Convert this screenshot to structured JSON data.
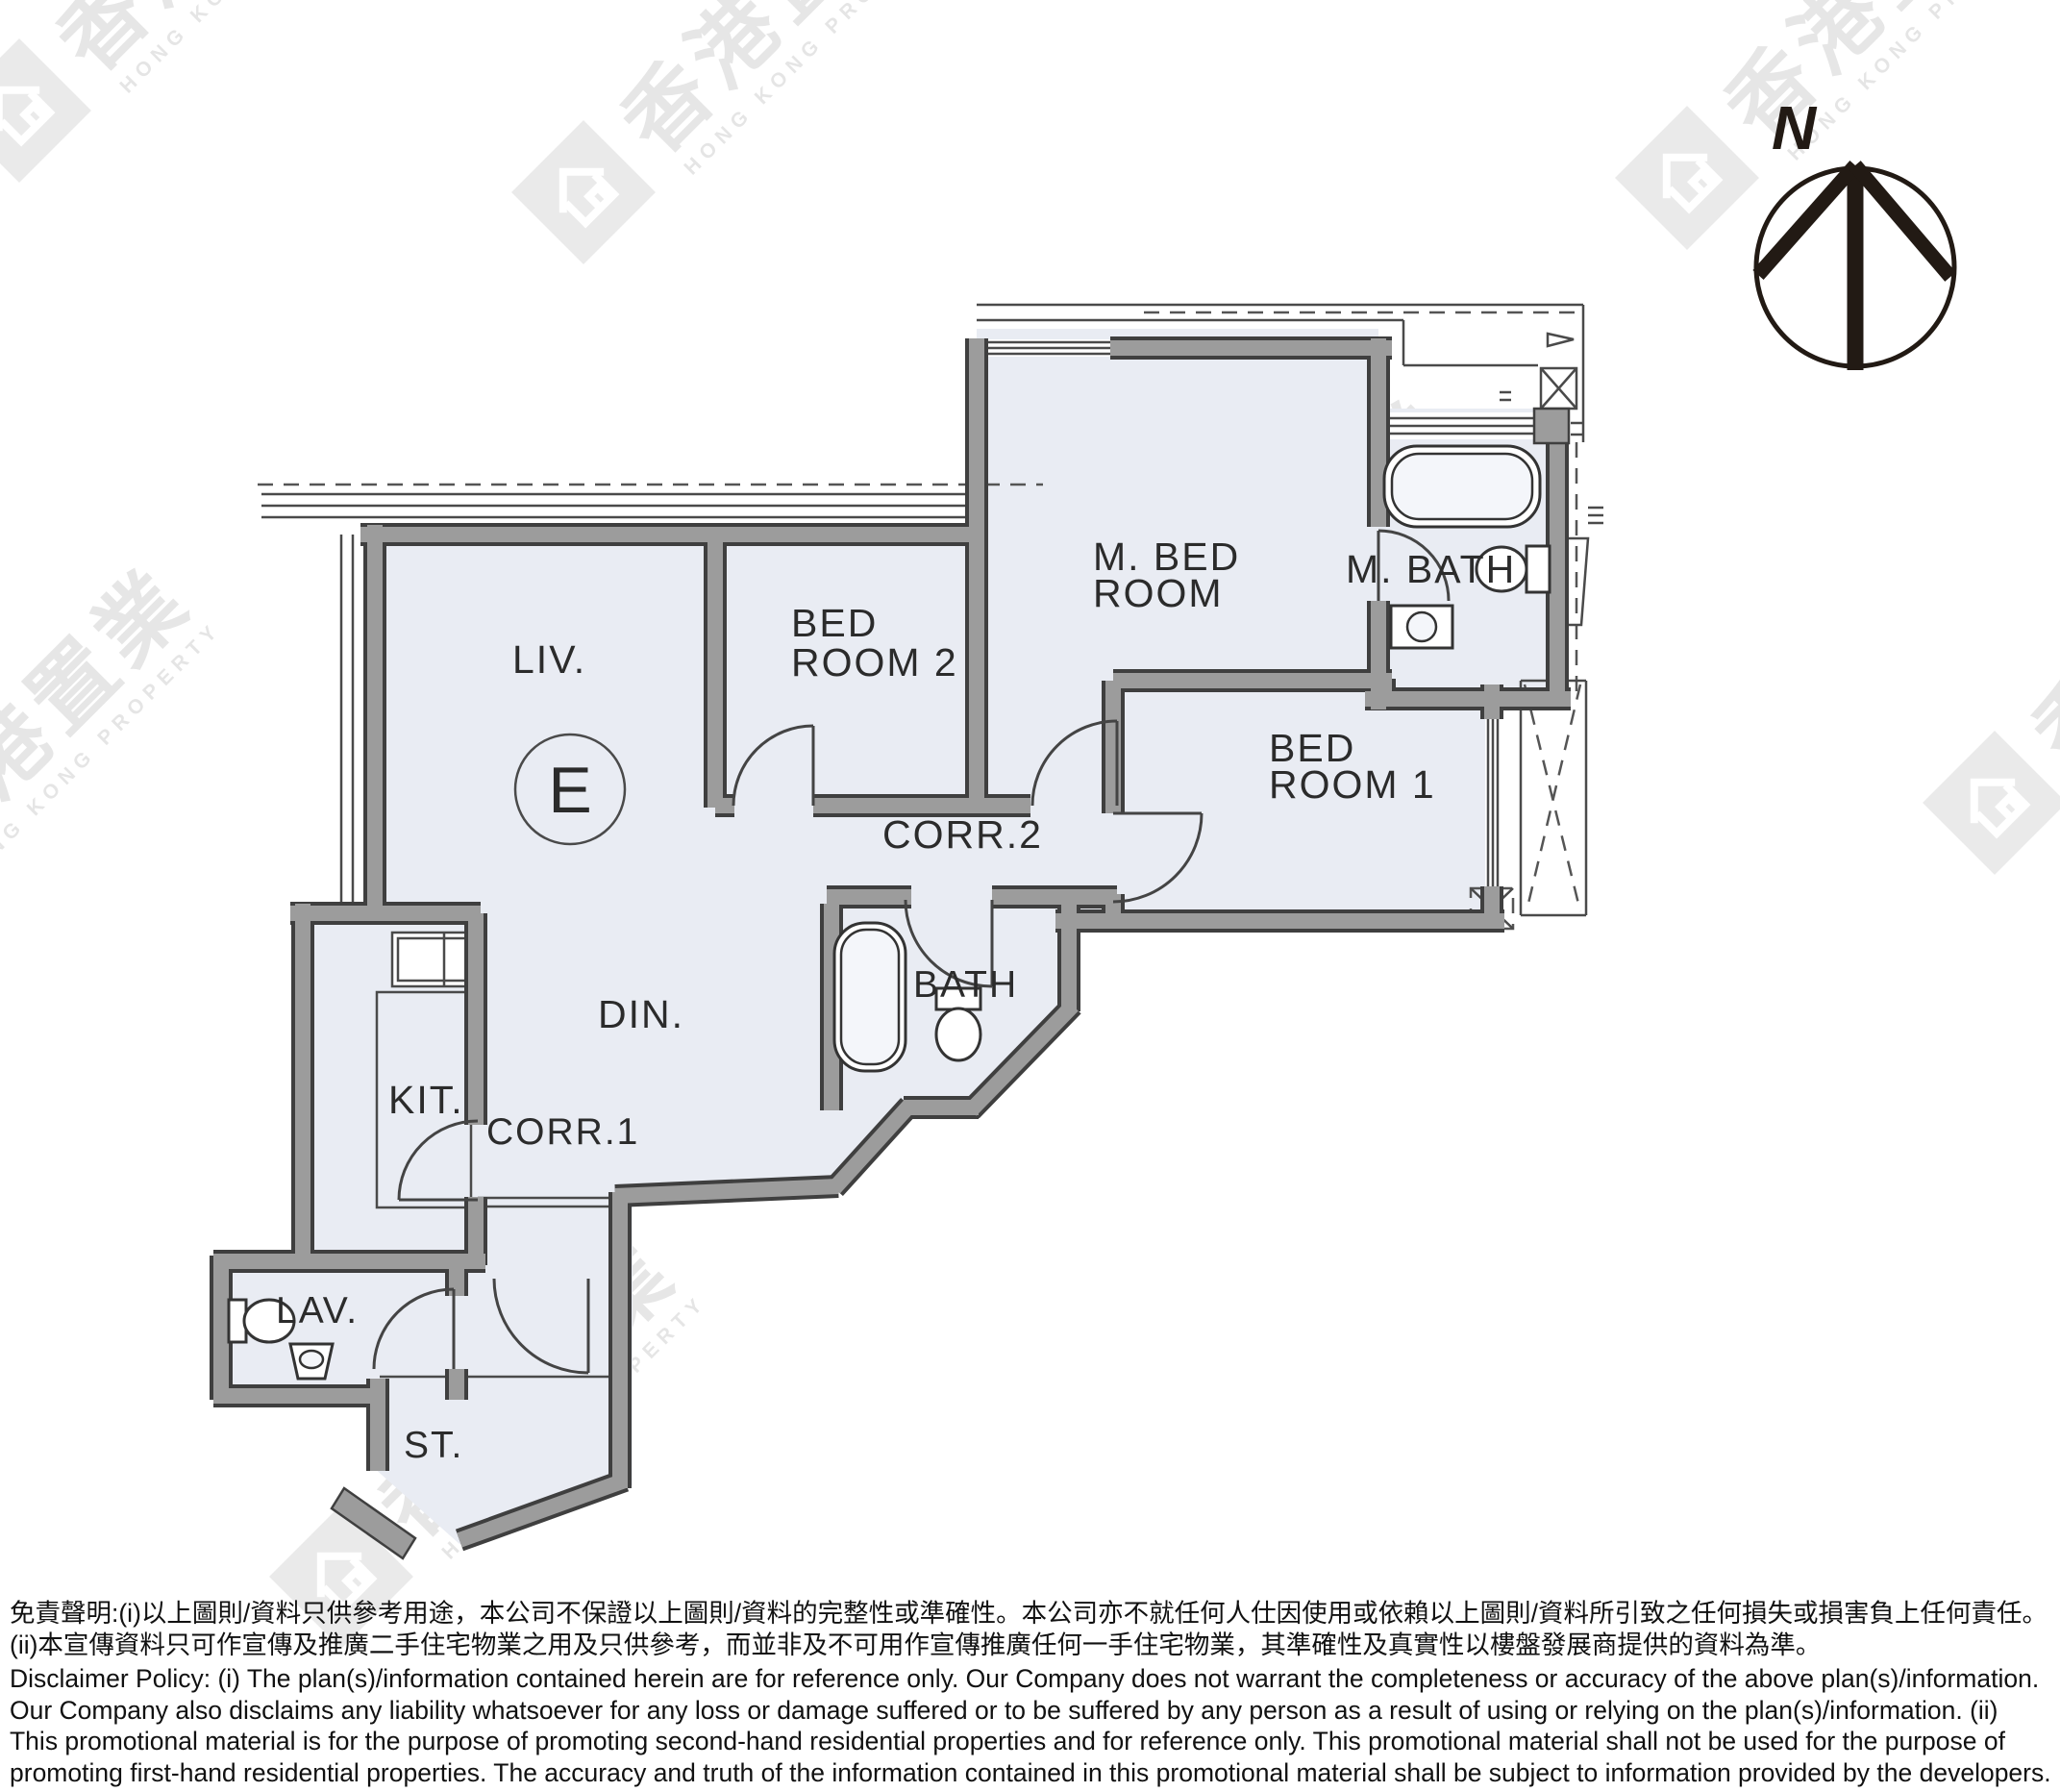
{
  "floor_plan": {
    "unit_label": "E",
    "compass": {
      "north_label": "N"
    },
    "rooms": {
      "living": "LIV.",
      "dining": "DIN.",
      "bedroom2_line1": "BED",
      "bedroom2_line2": "ROOM 2",
      "master_bedroom_line1": "M. BED",
      "master_bedroom_line2": "ROOM",
      "master_bath": "M. BATH",
      "bedroom1_line1": "BED",
      "bedroom1_line2": "ROOM 1",
      "corridor2": "CORR.2",
      "bath": "BATH",
      "kitchen": "KIT.",
      "corridor1": "CORR.1",
      "lavatory": "LAV.",
      "store": "ST."
    }
  },
  "watermark": {
    "cjk": "香港置業",
    "latin": "HONG KONG PROPERTY"
  },
  "disclaimer": {
    "zh": "免責聲明:(i)以上圖則/資料只供參考用途，本公司不保證以上圖則/資料的完整性或準確性。本公司亦不就任何人仕因使用或依賴以上圖則/資料所引致之任何損失或損害負上任何責任。(ii)本宣傳資料只可作宣傳及推廣二手住宅物業之用及只供參考，而並非及不可用作宣傳推廣任何一手住宅物業，其準確性及真實性以樓盤發展商提供的資料為準。",
    "en": "Disclaimer Policy: (i) The plan(s)/information contained herein are for reference only. Our Company does not warrant the completeness or accuracy of the above plan(s)/information. Our Company also disclaims any liability whatsoever for any loss or damage suffered or to be suffered by any person as a result of using or relying on the plan(s)/information. (ii) This promotional material is for the purpose of promoting second-hand residential properties and for reference only. This promotional material shall not be used for the purpose of promoting first-hand residential properties. The accuracy and truth of the information contained in this promotional material shall be subject to information provided by the developers."
  },
  "colors": {
    "wall_gray": "#9c9c9c",
    "wall_edge": "#3f3f3f",
    "floor_fill": "#e9ecf3",
    "watermark_gray": "#d0d0d0",
    "text": "#2b2b2b"
  }
}
